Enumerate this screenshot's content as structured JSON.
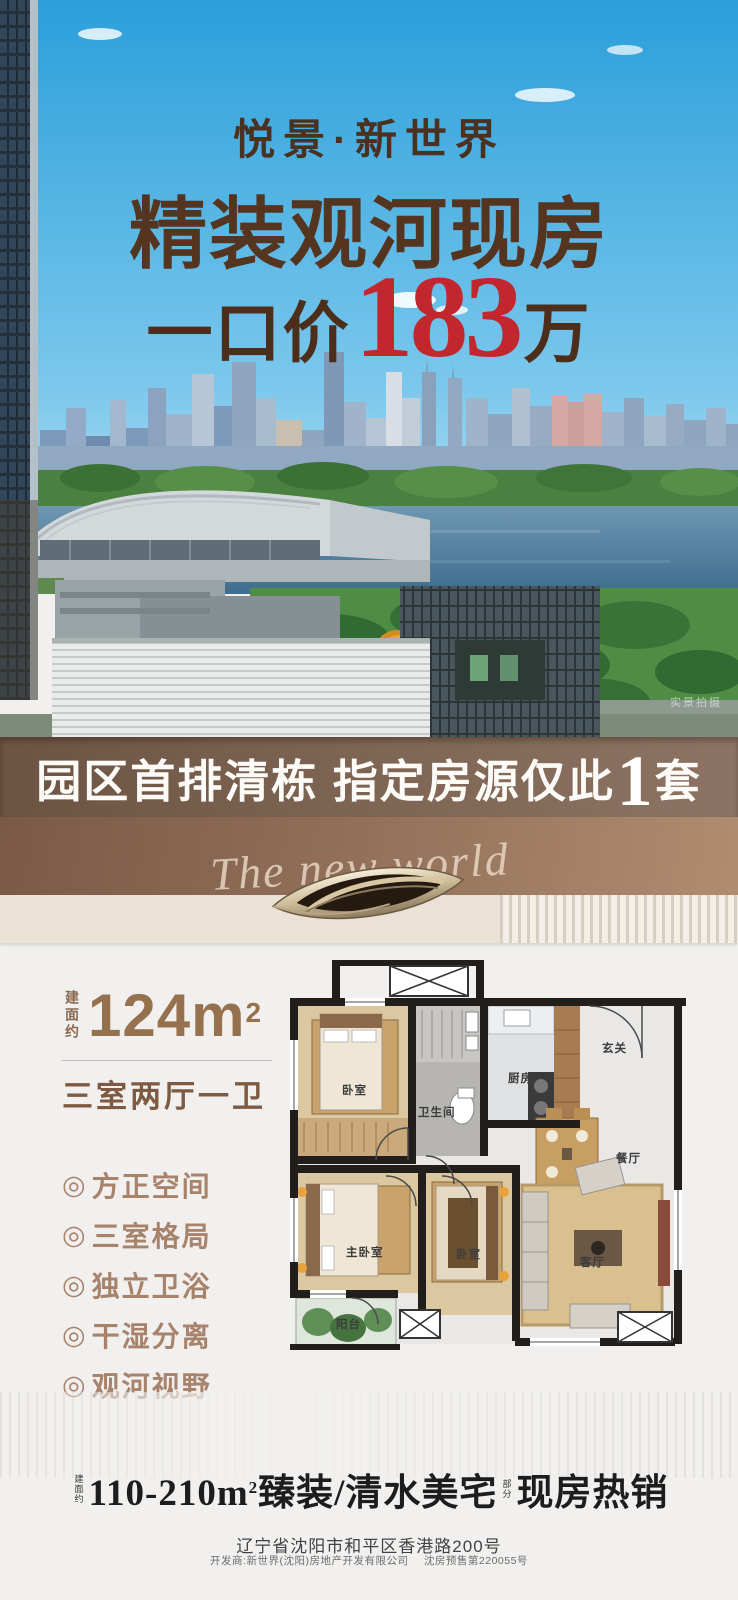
{
  "poster": {
    "project_name": "悦景·新世界",
    "headline": "精装观河现房",
    "price_prefix": "一口价",
    "price_number": "183",
    "price_suffix": "万",
    "photo_watermark": "实景拍摄"
  },
  "banner": {
    "text_main": "园区首排清栋 指定房源仅此",
    "highlight_number": "1",
    "text_tail": "套"
  },
  "deco": {
    "script_text": "The new world"
  },
  "unit": {
    "area_label": "建面约",
    "area_value": "124m",
    "area_sup": "2",
    "layout": "三室两厅一卫",
    "features": [
      {
        "bullet": "◎",
        "label": "方正空间"
      },
      {
        "bullet": "◎",
        "label": "三室格局"
      },
      {
        "bullet": "◎",
        "label": "独立卫浴"
      },
      {
        "bullet": "◎",
        "label": "干湿分离"
      },
      {
        "bullet": "◎",
        "label": "观河视野"
      }
    ]
  },
  "floorplan": {
    "rooms": [
      {
        "label": "卧室"
      },
      {
        "label": "卫生间"
      },
      {
        "label": "厨房"
      },
      {
        "label": "玄关"
      },
      {
        "label": "餐厅"
      },
      {
        "label": "主卧室"
      },
      {
        "label": "卧室"
      },
      {
        "label": "客厅"
      },
      {
        "label": "阳台"
      }
    ]
  },
  "footer": {
    "range_prefix": "建面约",
    "range_text": "110-210m",
    "range_sup": "2",
    "range_tail": "臻装/清水美宅",
    "partial_prefix": "部分",
    "sales_status": "现房热销",
    "address": "辽宁省沈阳市和平区香港路200号",
    "developer": "开发商:新世界(沈阳)房地产开发有限公司",
    "license": "沈房预售第220055号"
  },
  "colors": {
    "headline_brown": "#553520",
    "price_red": "#c2272e",
    "banner_bg": "#7d6351",
    "deco_brown": "#906e58",
    "cream": "#eae2d4",
    "accent_brown": "#96714e"
  }
}
